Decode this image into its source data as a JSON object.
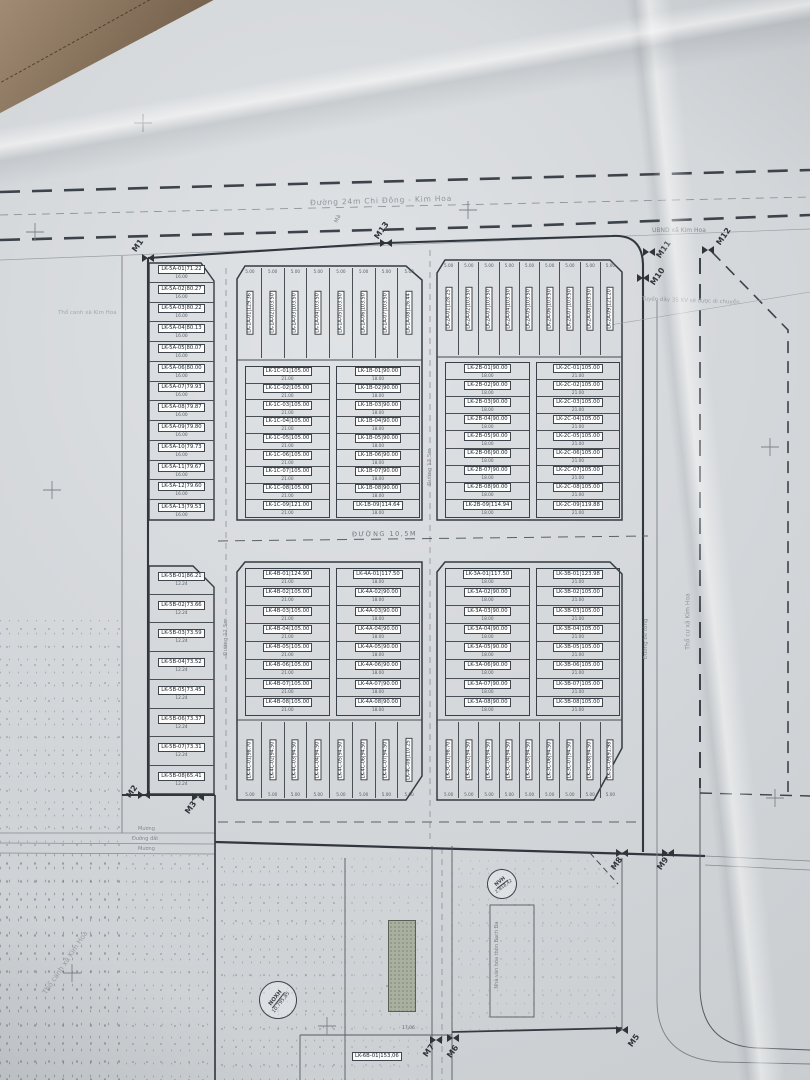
{
  "notes": {
    "top_road": "Đường 24m Chi Đông - Kim Hoa",
    "mid_road": "ĐƯỜNG 10,5M",
    "inner_road_left": "Đường 11,5m",
    "inner_road_center": "Đường 13,5m",
    "concrete_road": "Đường bê tông",
    "ubnd": "UBND xã Kim Hoa",
    "power": "Tuyến dây 35 KV sẽ được di chuyển",
    "left_field": "Thổ canh xã Kim Hoa",
    "left_field2": "Thổ canh xã Kim Hoa",
    "right_field": "Thổ cư xã Kim Hoa",
    "canal1": "Mương",
    "dirt_road": "Đường đất",
    "canal2": "Mương",
    "grave": "Mả",
    "nvh_building": "Nhà văn hóa thôn Bạch Đa"
  },
  "markers": [
    "M1",
    "M13",
    "M12",
    "M11",
    "M10",
    "M2",
    "M3",
    "M8",
    "M9",
    "M7",
    "M6",
    "M5"
  ],
  "stamps": [
    {
      "abbr": "NVH",
      "value": "2.818,42"
    },
    {
      "abbr": "NOXH",
      "value": "10.795,85"
    }
  ],
  "blocks": {
    "lk5a": {
      "dim": "16.00",
      "lots": [
        [
          "LK-5A-01",
          "71.22"
        ],
        [
          "LK-5A-02",
          "80.27"
        ],
        [
          "LK-5A-03",
          "80.22"
        ],
        [
          "LK-5A-04",
          "80.13"
        ],
        [
          "LK-5A-05",
          "80.07"
        ],
        [
          "LK-5A-06",
          "80.00"
        ],
        [
          "LK-5A-07",
          "79.93"
        ],
        [
          "LK-5A-08",
          "79.87"
        ],
        [
          "LK-5A-09",
          "79.80"
        ],
        [
          "LK-5A-10",
          "79.73"
        ],
        [
          "LK-5A-11",
          "79.67"
        ],
        [
          "LK-5A-12",
          "79.60"
        ],
        [
          "LK-5A-13",
          "79.53"
        ]
      ]
    },
    "lk5b": {
      "dim": "12.24",
      "lots": [
        [
          "LK-5B-01",
          "86.21"
        ],
        [
          "LK-5B-02",
          "73.66"
        ],
        [
          "LK-5B-03",
          "73.59"
        ],
        [
          "LK-5B-04",
          "73.52"
        ],
        [
          "LK-5B-05",
          "73.45"
        ],
        [
          "LK-5B-06",
          "73.37"
        ],
        [
          "LK-5B-07",
          "73.31"
        ],
        [
          "LK-5B-08",
          "65.41"
        ]
      ]
    },
    "lk1a": {
      "dim": "5.00",
      "lots": [
        [
          "LK-1A-01",
          "129.36"
        ],
        [
          "LK-1A-02",
          "103.50"
        ],
        [
          "LK-1A-03",
          "103.50"
        ],
        [
          "LK-1A-04",
          "103.50"
        ],
        [
          "LK-1A-05",
          "103.50"
        ],
        [
          "LK-1A-06",
          "103.50"
        ],
        [
          "LK-1A-07",
          "103.50"
        ],
        [
          "LK-1A-08",
          "126.44"
        ]
      ]
    },
    "lk2a": {
      "dim": "5.00",
      "lots": [
        [
          "LK-2A-01",
          "128.25"
        ],
        [
          "LK-2A-02",
          "103.50"
        ],
        [
          "LK-2A-03",
          "103.50"
        ],
        [
          "LK-2A-04",
          "103.50"
        ],
        [
          "LK-2A-05",
          "103.50"
        ],
        [
          "LK-2A-06",
          "103.50"
        ],
        [
          "LK-2A-07",
          "103.50"
        ],
        [
          "LK-2A-08",
          "103.50"
        ],
        [
          "LK-2A-09",
          "121.20"
        ]
      ]
    },
    "lk1c": {
      "dim": "21.00",
      "lots": [
        [
          "LK-1C-01",
          "105.00"
        ],
        [
          "LK-1C-02",
          "105.00"
        ],
        [
          "LK-1C-03",
          "105.00"
        ],
        [
          "LK-1C-04",
          "105.00"
        ],
        [
          "LK-1C-05",
          "105.00"
        ],
        [
          "LK-1C-06",
          "105.00"
        ],
        [
          "LK-1C-07",
          "105.00"
        ],
        [
          "LK-1C-08",
          "105.00"
        ],
        [
          "LK-1C-09",
          "121.00"
        ]
      ]
    },
    "lk1b": {
      "dim": "18.00",
      "lots": [
        [
          "LK-1B-01",
          "90.00"
        ],
        [
          "LK-1B-02",
          "90.00"
        ],
        [
          "LK-1B-03",
          "90.00"
        ],
        [
          "LK-1B-04",
          "90.00"
        ],
        [
          "LK-1B-05",
          "90.00"
        ],
        [
          "LK-1B-06",
          "90.00"
        ],
        [
          "LK-1B-07",
          "90.00"
        ],
        [
          "LK-1B-08",
          "90.00"
        ],
        [
          "LK-1B-09",
          "114.64"
        ]
      ]
    },
    "lk2b": {
      "dim": "18.00",
      "lots": [
        [
          "LK-2B-01",
          "90.00"
        ],
        [
          "LK-2B-02",
          "90.00"
        ],
        [
          "LK-2B-03",
          "90.00"
        ],
        [
          "LK-2B-04",
          "90.00"
        ],
        [
          "LK-2B-05",
          "90.00"
        ],
        [
          "LK-2B-06",
          "90.00"
        ],
        [
          "LK-2B-07",
          "90.00"
        ],
        [
          "LK-2B-08",
          "90.00"
        ],
        [
          "LK-2B-09",
          "114.94"
        ]
      ]
    },
    "lk2c": {
      "dim": "21.00",
      "lots": [
        [
          "LK-2C-01",
          "105.00"
        ],
        [
          "LK-2C-02",
          "105.00"
        ],
        [
          "LK-2C-03",
          "105.00"
        ],
        [
          "LK-2C-04",
          "105.00"
        ],
        [
          "LK-2C-05",
          "105.00"
        ],
        [
          "LK-2C-06",
          "105.00"
        ],
        [
          "LK-2C-07",
          "105.00"
        ],
        [
          "LK-2C-08",
          "105.00"
        ],
        [
          "LK-2C-09",
          "119.88"
        ]
      ]
    },
    "lk4b": {
      "dim": "21.00",
      "lots": [
        [
          "LK-4B-01",
          "124.90"
        ],
        [
          "LK-4B-02",
          "105.00"
        ],
        [
          "LK-4B-03",
          "105.00"
        ],
        [
          "LK-4B-04",
          "105.00"
        ],
        [
          "LK-4B-05",
          "105.00"
        ],
        [
          "LK-4B-06",
          "105.00"
        ],
        [
          "LK-4B-07",
          "105.00"
        ],
        [
          "LK-4B-08",
          "105.00"
        ]
      ]
    },
    "lk4a": {
      "dim": "18.00",
      "lots": [
        [
          "LK-4A-01",
          "117.50"
        ],
        [
          "LK-4A-02",
          "90.00"
        ],
        [
          "LK-4A-03",
          "90.00"
        ],
        [
          "LK-4A-04",
          "90.00"
        ],
        [
          "LK-4A-05",
          "90.00"
        ],
        [
          "LK-4A-06",
          "90.00"
        ],
        [
          "LK-4A-07",
          "90.00"
        ],
        [
          "LK-4A-08",
          "90.00"
        ]
      ]
    },
    "lk3a": {
      "dim": "18.00",
      "lots": [
        [
          "LK-3A-01",
          "117.50"
        ],
        [
          "LK-3A-02",
          "90.00"
        ],
        [
          "LK-3A-03",
          "90.00"
        ],
        [
          "LK-3A-04",
          "90.00"
        ],
        [
          "LK-3A-05",
          "90.00"
        ],
        [
          "LK-3A-06",
          "90.00"
        ],
        [
          "LK-3A-07",
          "90.00"
        ],
        [
          "LK-3A-08",
          "90.00"
        ]
      ]
    },
    "lk3b": {
      "dim": "21.00",
      "lots": [
        [
          "LK-3B-01",
          "123.98"
        ],
        [
          "LK-3B-02",
          "105.00"
        ],
        [
          "LK-3B-03",
          "105.00"
        ],
        [
          "LK-3B-04",
          "105.00"
        ],
        [
          "LK-3B-05",
          "105.00"
        ],
        [
          "LK-3B-06",
          "105.00"
        ],
        [
          "LK-3B-07",
          "105.00"
        ],
        [
          "LK-3B-08",
          "105.00"
        ]
      ]
    },
    "lk4c": {
      "dim": "5.00",
      "lots": [
        [
          "LK-4C-01",
          "98.70"
        ],
        [
          "LK-4C-02",
          "94.50"
        ],
        [
          "LK-4C-03",
          "94.50"
        ],
        [
          "LK-4C-04",
          "94.50"
        ],
        [
          "LK-4C-05",
          "94.50"
        ],
        [
          "LK-4C-06",
          "94.50"
        ],
        [
          "LK-4C-07",
          "94.50"
        ],
        [
          "LK-4C-08",
          "110.25"
        ]
      ]
    },
    "lk3c": {
      "dim": "5.00",
      "lots": [
        [
          "LK-3C-01",
          "98.70"
        ],
        [
          "LK-3C-02",
          "94.50"
        ],
        [
          "LK-3C-03",
          "94.50"
        ],
        [
          "LK-3C-04",
          "94.50"
        ],
        [
          "LK-3C-05",
          "94.50"
        ],
        [
          "LK-3C-06",
          "94.50"
        ],
        [
          "LK-3C-07",
          "94.50"
        ],
        [
          "LK-3C-08",
          "94.50"
        ],
        [
          "LK-3C-09",
          "91.98"
        ]
      ]
    },
    "lk6b": {
      "id": "LK-6B-01",
      "area": "153,06",
      "dim": "17.06"
    }
  }
}
